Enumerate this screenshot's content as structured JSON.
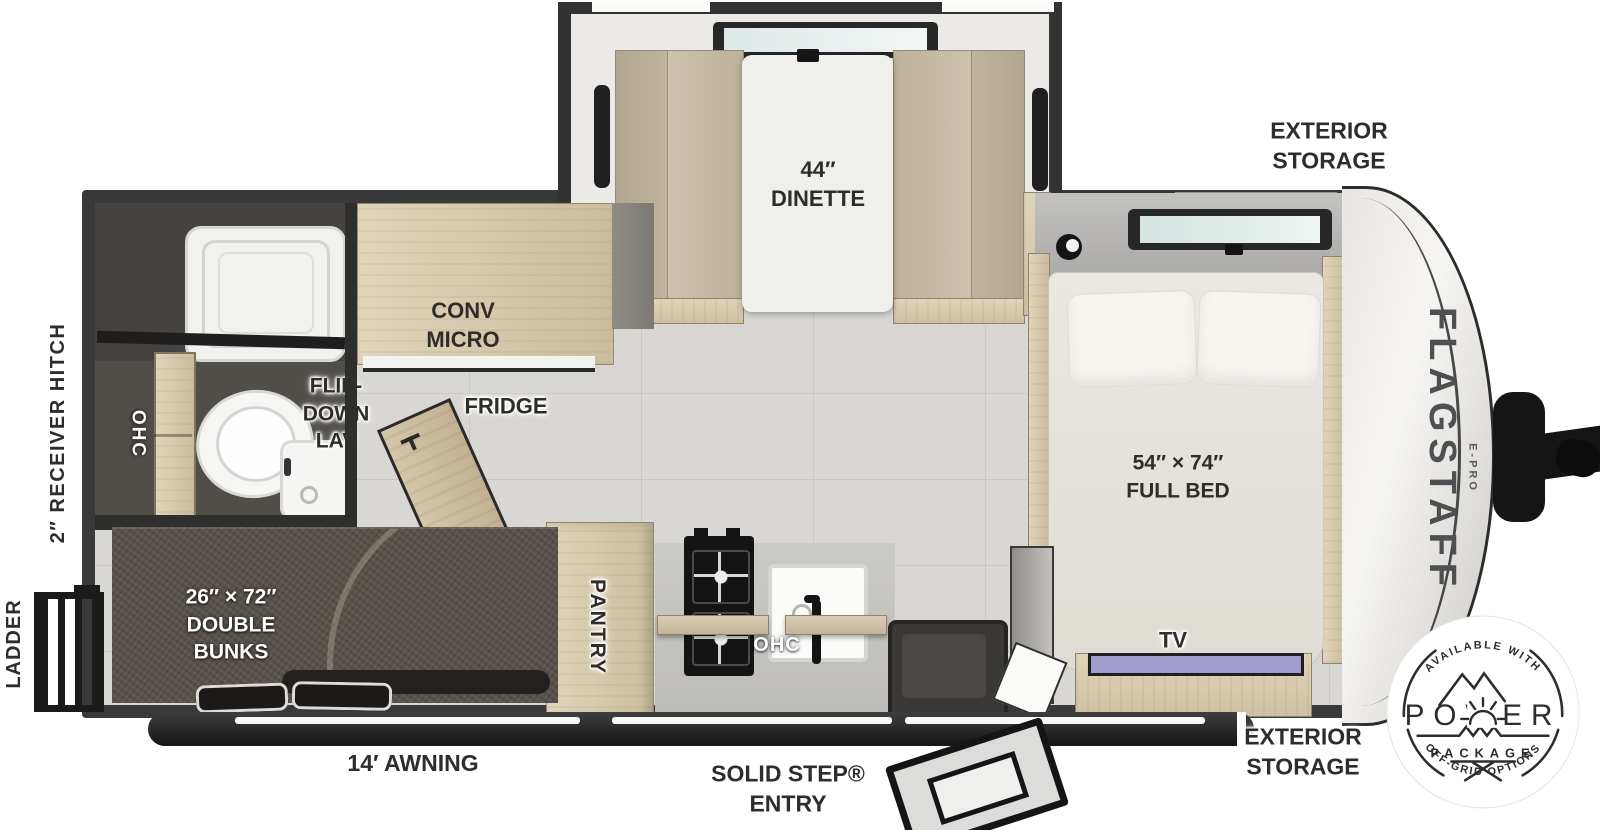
{
  "labels": {
    "dinette_size": "44″",
    "dinette": "DINETTE",
    "exterior_storage_top_1": "EXTERIOR",
    "exterior_storage_top_2": "STORAGE",
    "conv_micro_1": "CONV",
    "conv_micro_2": "MICRO",
    "fridge": "FRIDGE",
    "flip_down_lav_1": "FLIP-",
    "flip_down_lav_2": "DOWN",
    "flip_down_lav_3": "LAV",
    "ohc_bath": "OHC",
    "ohc_bed": "OHC",
    "ohc_kitchen": "OHC",
    "bed_size": "54″ × 74″",
    "bed_name": "FULL BED",
    "bunk_size": "26″ × 72″",
    "bunk_1": "DOUBLE",
    "bunk_2": "BUNKS",
    "pantry": "PANTRY",
    "tv": "TV",
    "receiver_hitch": "2″ RECEIVER HITCH",
    "ladder": "LADDER",
    "awning": "14′ AWNING",
    "entry_1": "SOLID STEP®",
    "entry_2": "ENTRY",
    "exterior_storage_bottom_1": "EXTERIOR",
    "exterior_storage_bottom_2": "STORAGE",
    "brand": "FLAGSTAFF",
    "brand_sub": "E-PRO"
  },
  "badge": {
    "top": "AVAILABLE WITH",
    "title": "POWER",
    "subtitle": "PACKAGE",
    "bottom": "OFF-GRID OPTIONS"
  },
  "colors": {
    "wall": "#39393a",
    "floor": "#d9d7d3",
    "wood": "#d8cbae",
    "bunk": "#57514a",
    "tv_screen": "#a29ed0",
    "badge_ink": "#2d2d2d"
  }
}
